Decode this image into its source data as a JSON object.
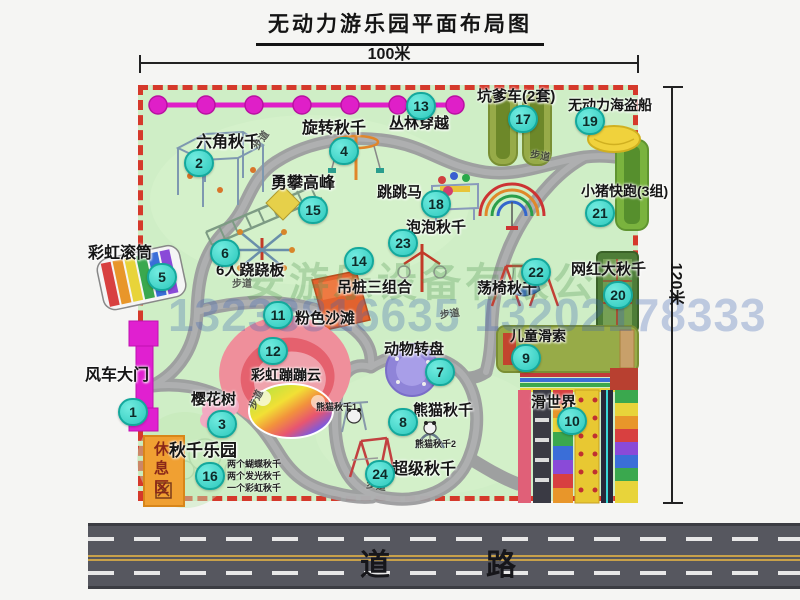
{
  "title": "无动力游乐园平面布局图",
  "dim_top_label": "100米",
  "dim_right_label": "120米",
  "road_label": "道　　路",
  "watermark_company": "安游乐设备有限公司",
  "watermark_phone": "13233816635 13202178333",
  "rest_area_label": "休息区",
  "path_label": "步道",
  "colors": {
    "park_green": "#cfeec6",
    "border_red": "#d5392b",
    "badge_teal": "#2cc8bc",
    "zipline_magenta": "#df1fc8",
    "gate_magenta": "#e020d0",
    "road_gray": "#56575f"
  },
  "trails": [
    {
      "x": 252,
      "y": 136,
      "rot": -55
    },
    {
      "x": 530,
      "y": 152,
      "rot": 10
    },
    {
      "x": 232,
      "y": 280,
      "rot": 0
    },
    {
      "x": 440,
      "y": 310,
      "rot": -8
    },
    {
      "x": 247,
      "y": 395,
      "rot": -65
    },
    {
      "x": 366,
      "y": 482,
      "rot": 8
    }
  ],
  "notes": [
    {
      "text": "熊猫秋千1",
      "x": 316,
      "y": 403
    },
    {
      "text": "熊猫秋千2",
      "x": 415,
      "y": 440
    },
    {
      "text": "两个蝴蝶秋千",
      "x": 227,
      "y": 460
    },
    {
      "text": "两个发光秋千",
      "x": 227,
      "y": 472
    },
    {
      "text": "一个彩虹秋千",
      "x": 227,
      "y": 484
    }
  ],
  "items": [
    {
      "num": 1,
      "label": "风车大门",
      "bx": 133,
      "by": 412,
      "lx": 85,
      "ly": 368,
      "fs": 16
    },
    {
      "num": 2,
      "label": "六角秋千",
      "bx": 199,
      "by": 163,
      "lx": 196,
      "ly": 135,
      "fs": 16
    },
    {
      "num": 3,
      "label": "樱花树",
      "bx": 222,
      "by": 424,
      "lx": 191,
      "ly": 392,
      "fs": 15
    },
    {
      "num": 4,
      "label": "旋转秋千",
      "bx": 344,
      "by": 151,
      "lx": 302,
      "ly": 121,
      "fs": 16
    },
    {
      "num": 5,
      "label": "彩虹滚筒",
      "bx": 162,
      "by": 277,
      "lx": 88,
      "ly": 246,
      "fs": 16
    },
    {
      "num": 6,
      "label": "6人跷跷板",
      "bx": 225,
      "by": 253,
      "lx": 216,
      "ly": 263,
      "fs": 15
    },
    {
      "num": 7,
      "label": "动物转盘",
      "bx": 440,
      "by": 372,
      "lx": 384,
      "ly": 342,
      "fs": 15
    },
    {
      "num": 8,
      "label": "熊猫秋千",
      "bx": 403,
      "by": 422,
      "lx": 413,
      "ly": 403,
      "fs": 15
    },
    {
      "num": 9,
      "label": "儿童滑索",
      "bx": 526,
      "by": 358,
      "lx": 510,
      "ly": 329,
      "fs": 14
    },
    {
      "num": 10,
      "label": "滑世界",
      "bx": 572,
      "by": 421,
      "lx": 531,
      "ly": 395,
      "fs": 15
    },
    {
      "num": 11,
      "label": "粉色沙滩",
      "bx": 278,
      "by": 315,
      "lx": 295,
      "ly": 311,
      "fs": 15
    },
    {
      "num": 12,
      "label": "彩虹蹦蹦云",
      "bx": 273,
      "by": 351,
      "lx": 251,
      "ly": 368,
      "fs": 14
    },
    {
      "num": 13,
      "label": "丛林穿越",
      "bx": 421,
      "by": 106,
      "lx": 389,
      "ly": 116,
      "fs": 15
    },
    {
      "num": 14,
      "label": "吊桩三组合",
      "bx": 359,
      "by": 261,
      "lx": 337,
      "ly": 280,
      "fs": 15
    },
    {
      "num": 15,
      "label": "勇攀高峰",
      "bx": 313,
      "by": 210,
      "lx": 271,
      "ly": 176,
      "fs": 16
    },
    {
      "num": 16,
      "label": "秋千乐园",
      "bx": 210,
      "by": 476,
      "lx": 169,
      "ly": 442,
      "fs": 17
    },
    {
      "num": 17,
      "label": "坑爹车(2套)",
      "bx": 523,
      "by": 119,
      "lx": 477,
      "ly": 89,
      "fs": 15
    },
    {
      "num": 18,
      "label": "跳跳马",
      "bx": 436,
      "by": 204,
      "lx": 377,
      "ly": 185,
      "fs": 15
    },
    {
      "num": 19,
      "label": "无动力海盗船",
      "bx": 590,
      "by": 121,
      "lx": 568,
      "ly": 98,
      "fs": 14
    },
    {
      "num": 20,
      "label": "网红大秋千",
      "bx": 618,
      "by": 295,
      "lx": 571,
      "ly": 262,
      "fs": 15
    },
    {
      "num": 21,
      "label": "小猪快跑(3组)",
      "bx": 600,
      "by": 213,
      "lx": 581,
      "ly": 184,
      "fs": 14
    },
    {
      "num": 22,
      "label": "荡椅秋千",
      "bx": 536,
      "by": 272,
      "lx": 477,
      "ly": 281,
      "fs": 15
    },
    {
      "num": 23,
      "label": "泡泡秋千",
      "bx": 403,
      "by": 243,
      "lx": 406,
      "ly": 220,
      "fs": 15
    },
    {
      "num": 24,
      "label": "超级秋千",
      "bx": 380,
      "by": 474,
      "lx": 392,
      "ly": 462,
      "fs": 16
    }
  ]
}
